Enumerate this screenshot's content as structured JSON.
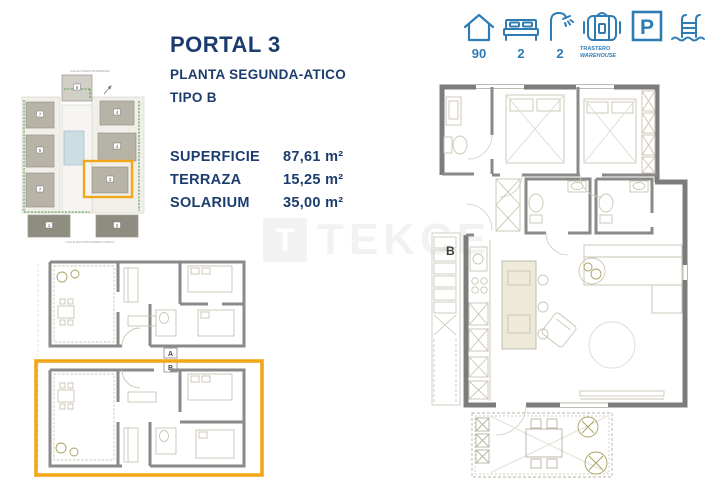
{
  "palette": {
    "navy": "#1d3c6e",
    "icon_blue": "#2f7cb5",
    "accent_orange": "#f2a71b",
    "wall_gray": "#7c7c7c"
  },
  "header": {
    "portal": "PORTAL 3",
    "planta": "PLANTA SEGUNDA-ATICO",
    "tipo": "TIPO B"
  },
  "specs": [
    {
      "label": "SUPERFICIE",
      "value": "87,61 m²"
    },
    {
      "label": "TERRAZA",
      "value": "15,25 m²"
    },
    {
      "label": "SOLARIUM",
      "value": "35,00 m²"
    }
  ],
  "amenities": [
    {
      "name": "surface-m2",
      "value": "90"
    },
    {
      "name": "bedrooms",
      "value": "2"
    },
    {
      "name": "bathrooms",
      "value": "2"
    },
    {
      "name": "storage",
      "value": "TRASTERO",
      "value2": "WAREHOUSE"
    },
    {
      "name": "parking",
      "value": "P"
    },
    {
      "name": "pool",
      "value": ""
    }
  ],
  "site_plan": {
    "street_top": "CALLE NUEVO RODRIGUEZ",
    "street_bottom": "CALLE DOCTOR ARTERO GUIRAO",
    "blocks": [
      "6",
      "7",
      "5",
      "7",
      "4",
      "4",
      "3",
      "1",
      "2"
    ]
  },
  "floor_plans": {
    "unit_a": "A",
    "unit_b": "B",
    "main_unit": "B"
  },
  "watermark": {
    "logo": "T",
    "text": "TEKCE"
  }
}
